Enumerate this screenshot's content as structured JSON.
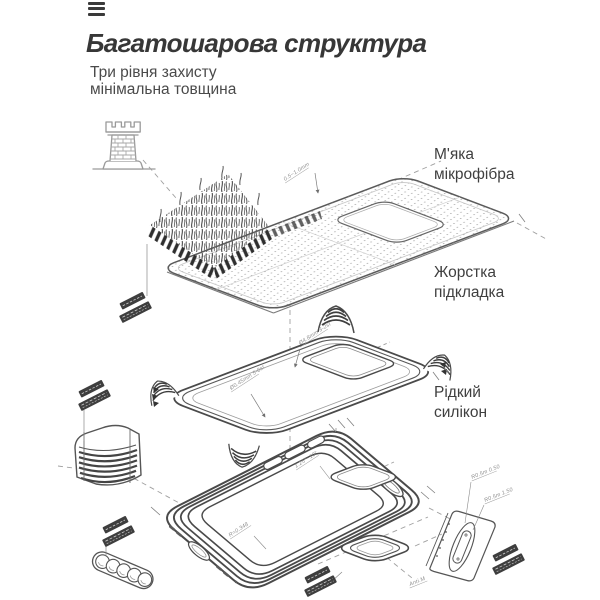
{
  "header": {
    "title": "Багатошарова структура",
    "subtitle_line1": "Три рівня захисту",
    "subtitle_line2": "мінімальна товщина"
  },
  "menu": {
    "icon": "hamburger-menu"
  },
  "hero": {
    "icon": "castle-tower"
  },
  "callouts": {
    "microfiber": {
      "line1": "М'яка",
      "line2": "мікрофібра"
    },
    "liner": {
      "line1": "Жорстка",
      "line2": "підкладка"
    },
    "silicone": {
      "line1": "Рідкий",
      "line2": "силікон"
    }
  },
  "diagram": {
    "layers": [
      "soft-microfiber-sheet",
      "hard-liner-tray",
      "liquid-silicone-case"
    ],
    "microtext": {
      "sheet_thickness": "0.5~1.0mm",
      "tray_dim_a": "Ø4.8mm 3-2st",
      "tray_dim_b": "Ø0.45mm 5-8st",
      "case_angle": "1.25°~10°",
      "case_radius": "R=0.348",
      "plate_dim_a": "R0.5m 0.50",
      "plate_dim_b": "R0.5m 1.50",
      "plate_dim_c": "Anti.M"
    },
    "colors": {
      "line": "#4a4a4a",
      "line_mid": "#777777",
      "line_light": "#b5b5b5",
      "dashed_guide": "#a0a0a0",
      "tag_fill": "#3e3e3e",
      "dot": "#8d8d8d",
      "title_text": "#373737",
      "label_text": "#3f3f3f"
    }
  }
}
